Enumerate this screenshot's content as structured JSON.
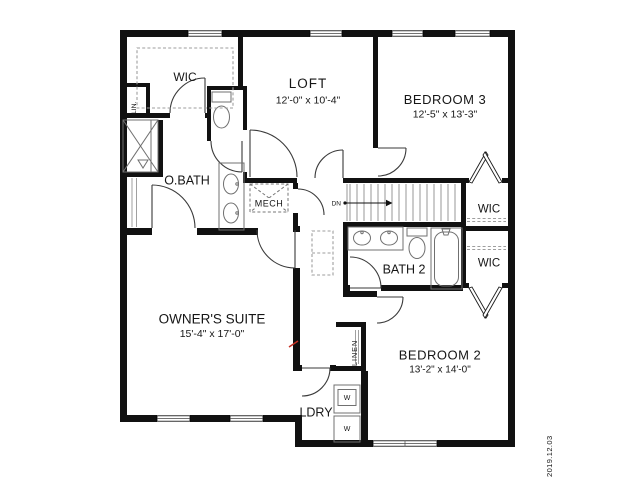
{
  "plan": {
    "rooms": {
      "wic_master": {
        "label": "WIC"
      },
      "lin": {
        "label": "LIN."
      },
      "owners_bath": {
        "label": "O.BATH"
      },
      "mech": {
        "label": "MECH"
      },
      "loft": {
        "label": "LOFT",
        "dims": "12'-0\" x 10'-4\""
      },
      "bedroom3": {
        "label": "BEDROOM 3",
        "dims": "12'-5\" x 13'-3\""
      },
      "wic_upper": {
        "label": "WIC"
      },
      "wic_lower": {
        "label": "WIC"
      },
      "bath2": {
        "label": "BATH 2"
      },
      "owners_suite": {
        "label": "OWNER'S SUITE",
        "dims": "15'-4\" x 17'-0\""
      },
      "linen": {
        "label": "LINEN"
      },
      "bedroom2": {
        "label": "BEDROOM 2",
        "dims": "13'-2\" x 14'-0\""
      },
      "laundry": {
        "label": "LDRY"
      }
    },
    "stairs": {
      "direction_label": "DN"
    },
    "appliances": {
      "washer_top": "W",
      "washer_bottom": "W"
    },
    "date_stamp": "2019.12.03",
    "colors": {
      "wall": "#111111",
      "text": "#161616",
      "fixture": "#707070",
      "mark": "#c53024"
    }
  }
}
